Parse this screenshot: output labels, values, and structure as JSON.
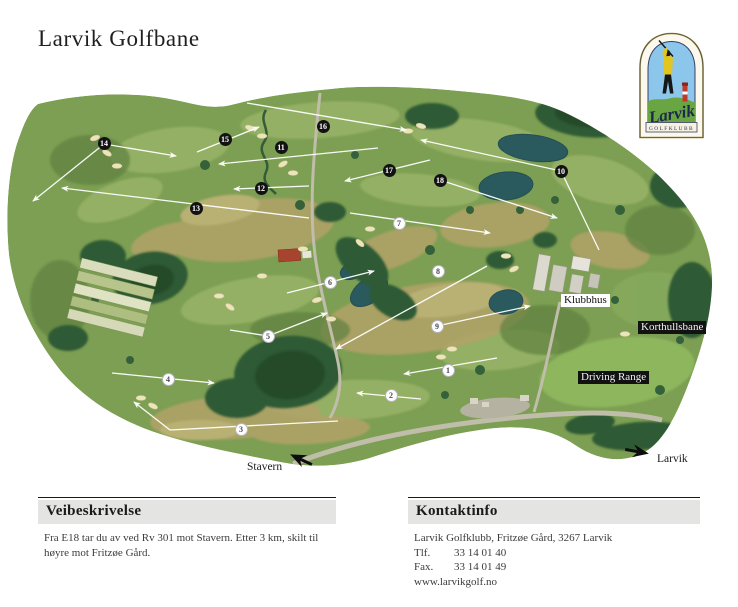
{
  "header": {
    "title": "Larvik Golfbane"
  },
  "logo": {
    "script_text": "Larvik",
    "banner_text": "GOLFKLUBB"
  },
  "map": {
    "holes": [
      {
        "n": 1,
        "x": 448,
        "y": 370,
        "variant": "light"
      },
      {
        "n": 2,
        "x": 391,
        "y": 395,
        "variant": "light"
      },
      {
        "n": 3,
        "x": 241,
        "y": 429,
        "variant": "light"
      },
      {
        "n": 4,
        "x": 168,
        "y": 379,
        "variant": "light"
      },
      {
        "n": 5,
        "x": 268,
        "y": 336,
        "variant": "light"
      },
      {
        "n": 6,
        "x": 330,
        "y": 282,
        "variant": "light"
      },
      {
        "n": 7,
        "x": 399,
        "y": 223,
        "variant": "light"
      },
      {
        "n": 8,
        "x": 438,
        "y": 271,
        "variant": "light"
      },
      {
        "n": 9,
        "x": 437,
        "y": 326,
        "variant": "light"
      },
      {
        "n": 10,
        "x": 561,
        "y": 171,
        "variant": "dark"
      },
      {
        "n": 11,
        "x": 281,
        "y": 147,
        "variant": "dark"
      },
      {
        "n": 12,
        "x": 261,
        "y": 188,
        "variant": "dark"
      },
      {
        "n": 13,
        "x": 196,
        "y": 208,
        "variant": "dark"
      },
      {
        "n": 14,
        "x": 104,
        "y": 143,
        "variant": "dark"
      },
      {
        "n": 15,
        "x": 225,
        "y": 139,
        "variant": "dark"
      },
      {
        "n": 16,
        "x": 323,
        "y": 126,
        "variant": "dark"
      },
      {
        "n": 17,
        "x": 389,
        "y": 170,
        "variant": "dark"
      },
      {
        "n": 18,
        "x": 440,
        "y": 180,
        "variant": "dark"
      }
    ],
    "hole_lines": [
      {
        "x1": 497,
        "y1": 358,
        "x2": 404,
        "y2": 374,
        "arrow": true
      },
      {
        "x1": 421,
        "y1": 399,
        "x2": 357,
        "y2": 393,
        "arrow": true
      },
      {
        "x1": 338,
        "y1": 421,
        "x2": 170,
        "y2": 430,
        "arrow": false
      },
      {
        "x1": 170,
        "y1": 430,
        "x2": 134,
        "y2": 402,
        "arrow": true
      },
      {
        "x1": 112,
        "y1": 373,
        "x2": 214,
        "y2": 383,
        "arrow": true
      },
      {
        "x1": 230,
        "y1": 330,
        "x2": 268,
        "y2": 336,
        "arrow": false
      },
      {
        "x1": 268,
        "y1": 336,
        "x2": 327,
        "y2": 313,
        "arrow": true
      },
      {
        "x1": 287,
        "y1": 293,
        "x2": 374,
        "y2": 271,
        "arrow": true
      },
      {
        "x1": 350,
        "y1": 213,
        "x2": 490,
        "y2": 233,
        "arrow": true
      },
      {
        "x1": 487,
        "y1": 266,
        "x2": 336,
        "y2": 349,
        "arrow": true
      },
      {
        "x1": 437,
        "y1": 326,
        "x2": 530,
        "y2": 306,
        "arrow": true
      },
      {
        "x1": 561,
        "y1": 171,
        "x2": 421,
        "y2": 140,
        "arrow": true
      },
      {
        "x1": 561,
        "y1": 171,
        "x2": 599,
        "y2": 250,
        "arrow": false
      },
      {
        "x1": 378,
        "y1": 148,
        "x2": 219,
        "y2": 164,
        "arrow": true
      },
      {
        "x1": 309,
        "y1": 186,
        "x2": 234,
        "y2": 189,
        "arrow": true
      },
      {
        "x1": 309,
        "y1": 218,
        "x2": 62,
        "y2": 188,
        "arrow": true
      },
      {
        "x1": 104,
        "y1": 144,
        "x2": 176,
        "y2": 156,
        "arrow": true
      },
      {
        "x1": 104,
        "y1": 144,
        "x2": 33,
        "y2": 201,
        "arrow": true
      },
      {
        "x1": 197,
        "y1": 152,
        "x2": 259,
        "y2": 127,
        "arrow": true
      },
      {
        "x1": 247,
        "y1": 103,
        "x2": 406,
        "y2": 130,
        "arrow": true
      },
      {
        "x1": 430,
        "y1": 160,
        "x2": 345,
        "y2": 181,
        "arrow": true
      },
      {
        "x1": 440,
        "y1": 180,
        "x2": 557,
        "y2": 218,
        "arrow": true
      }
    ],
    "labels": [
      {
        "text": "Klubbhus",
        "style": "light",
        "x": 561,
        "y": 294
      },
      {
        "text": "Korthullsbane",
        "style": "dark",
        "x": 638,
        "y": 321
      },
      {
        "text": "Driving Range",
        "style": "dark",
        "x": 578,
        "y": 371
      }
    ],
    "directions": [
      {
        "label": "Stavern",
        "heading": "southwest"
      },
      {
        "label": "Larvik",
        "heading": "east"
      }
    ]
  },
  "footer": {
    "directions": {
      "heading": "Veibeskrivelse",
      "body": "Fra E18 tar du av ved Rv 301 mot Stavern. Etter 3 km, skilt til høyre mot Fritzøe Gård."
    },
    "contact": {
      "heading": "Kontaktinfo",
      "address": "Larvik Golfklubb, Fritzøe Gård, 3267 Larvik",
      "phone_label": "Tlf.",
      "phone": "33 14 01 40",
      "fax_label": "Fax.",
      "fax": "33 14 01 49",
      "website": "www.larvikgolf.no"
    }
  },
  "colors": {
    "marker_dark": "#121212",
    "marker_light": "#fdfdfd",
    "label_dark_bg": "#121212",
    "course_green": "#7d9f53",
    "header_bar_gray": "#e4e4e2"
  }
}
